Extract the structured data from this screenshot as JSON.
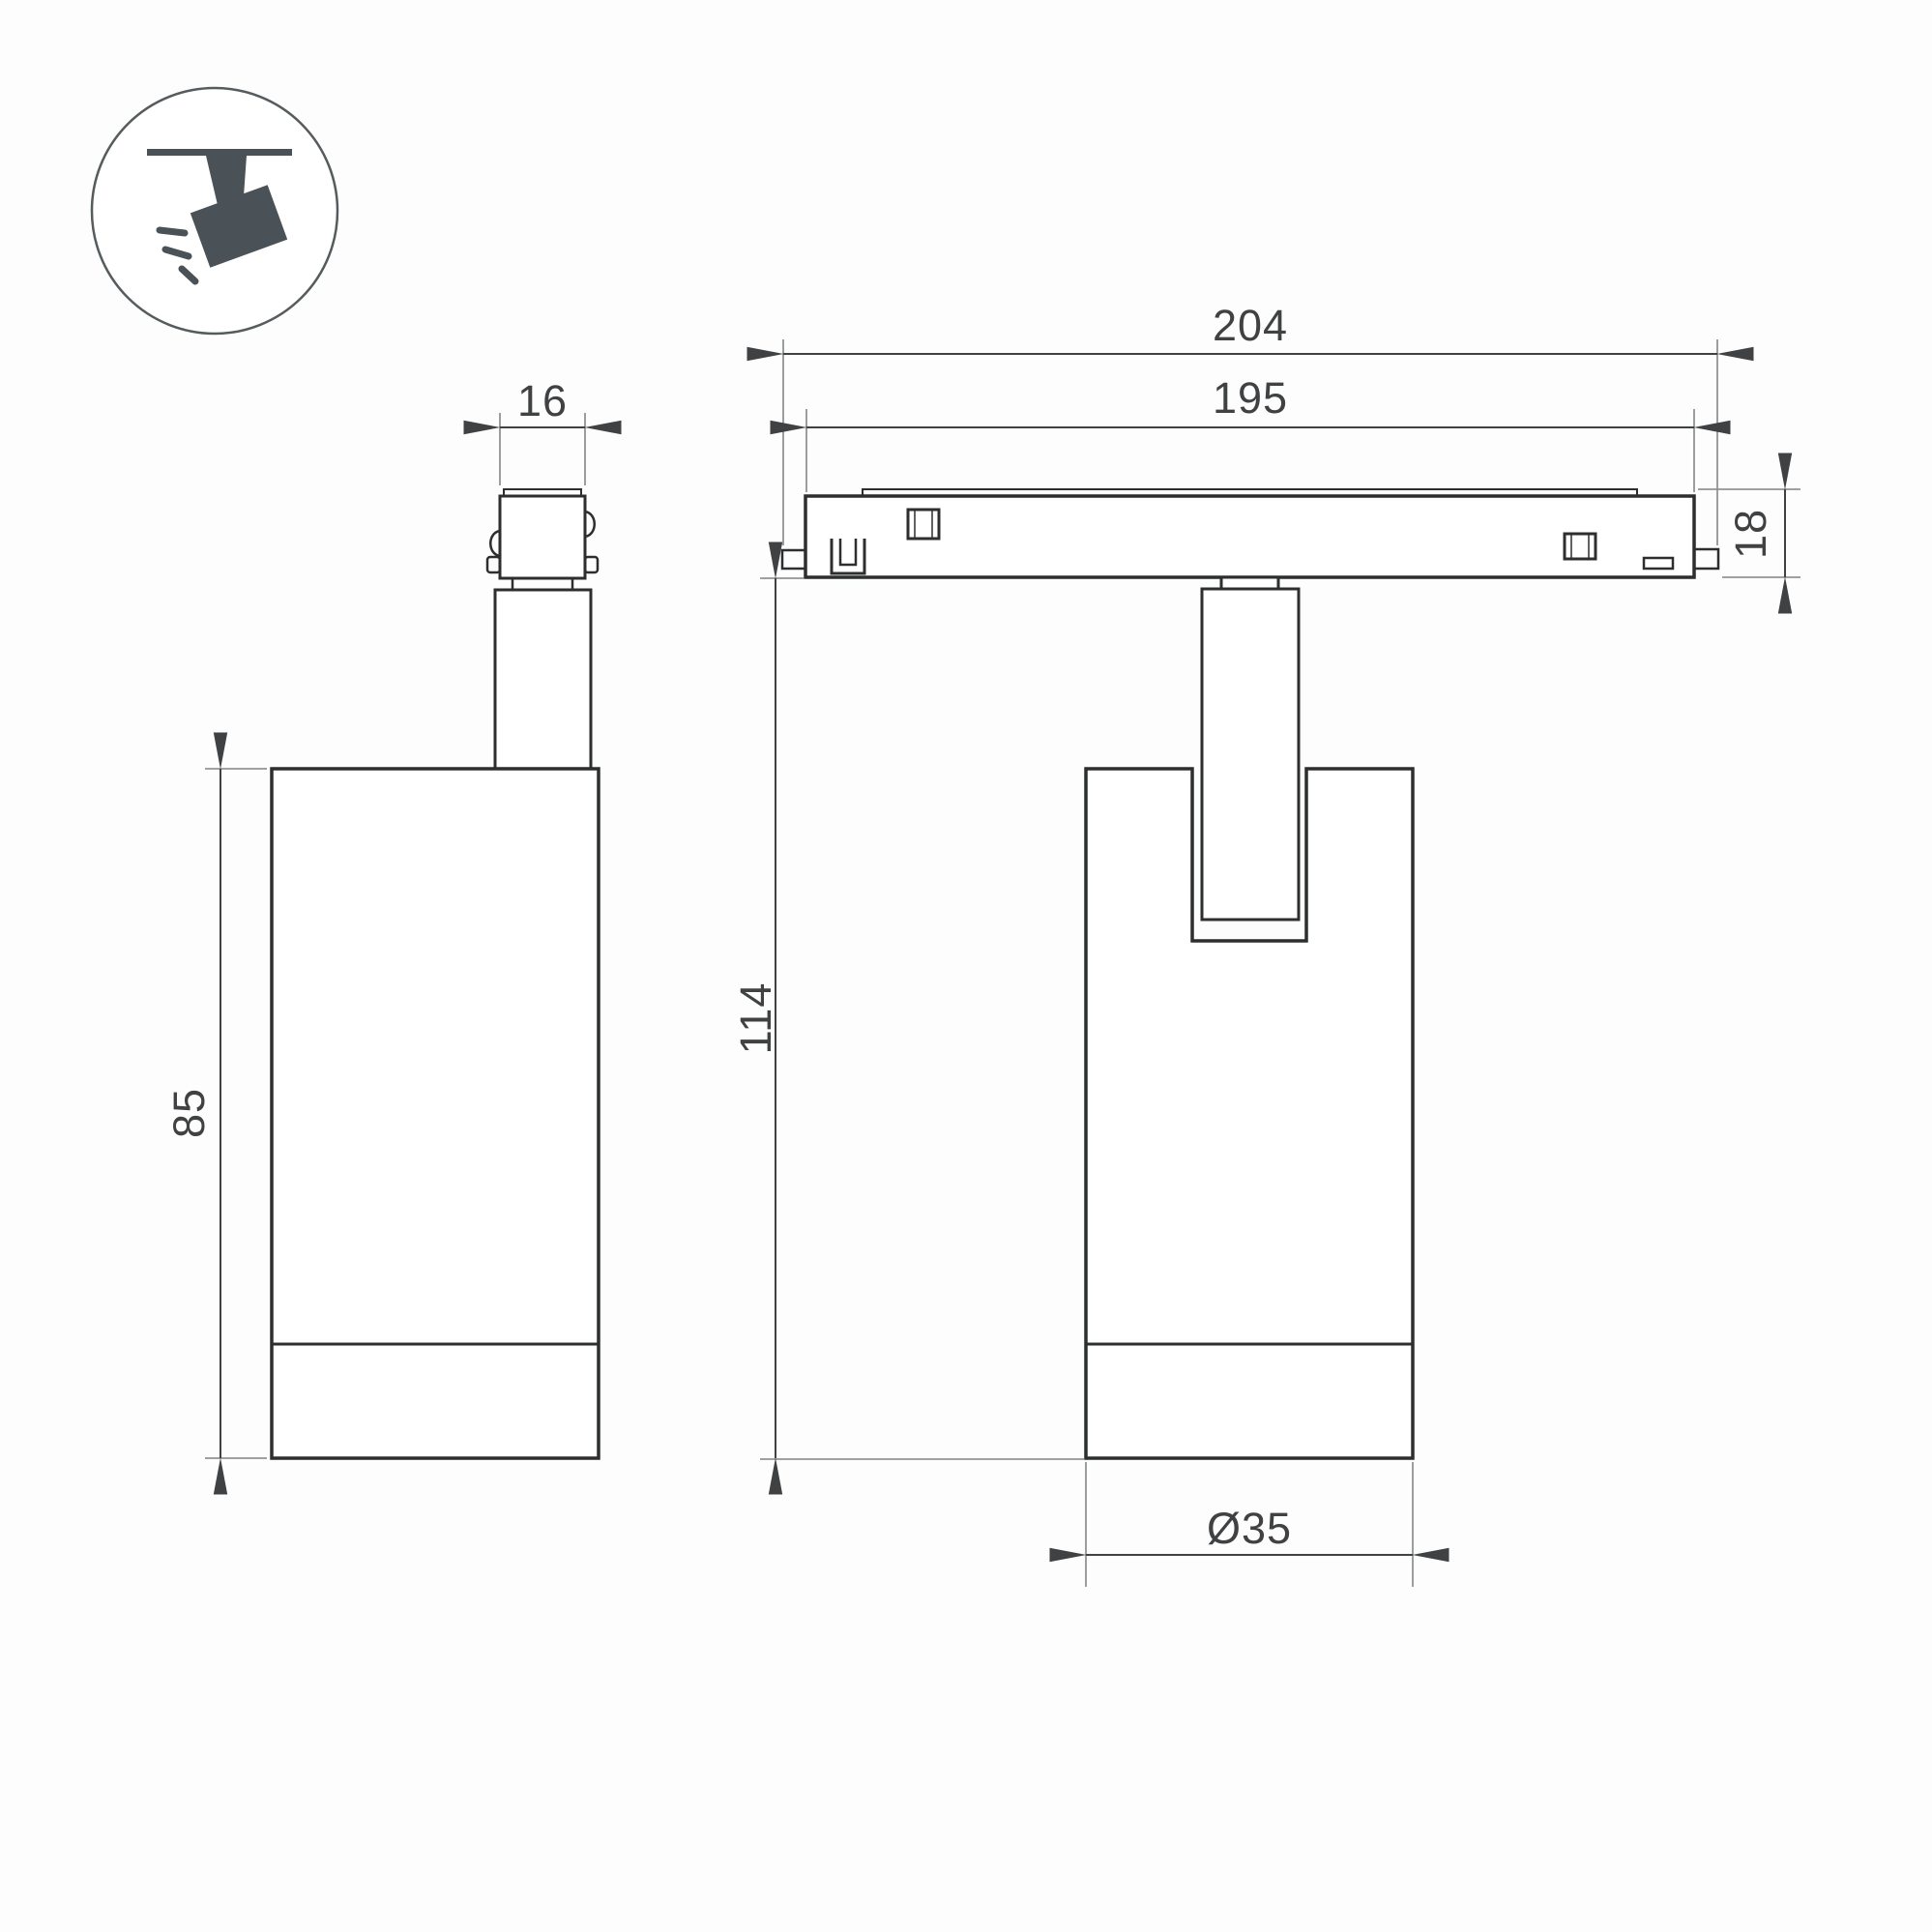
{
  "icon": {
    "name": "ceiling-track-spotlight-pictogram"
  },
  "dimensions": {
    "connector_width": "16",
    "body_height": "85",
    "track_length": "204",
    "track_inner_length": "195",
    "track_height": "18",
    "overall_height": "114",
    "body_diameter": "Ø35"
  },
  "colors": {
    "outline": "#2c2e2f",
    "dimension": "#3f4142",
    "extension": "#909394",
    "icon": "#4a5257",
    "background": "#fdfdfd"
  }
}
